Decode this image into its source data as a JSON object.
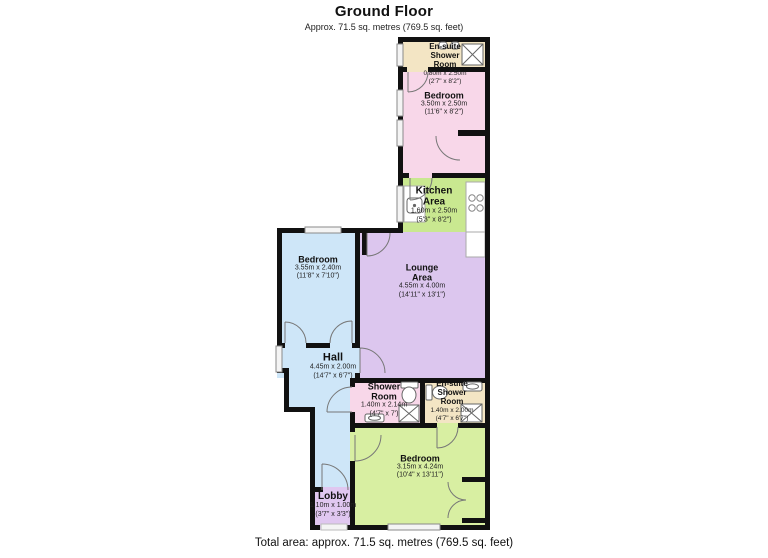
{
  "header": {
    "title": "Ground Floor",
    "subtitle": "Approx. 71.5 sq. metres (769.5 sq. feet)"
  },
  "footer": {
    "total_area": "Total area: approx. 71.5 sq. metres (769.5 sq. feet)"
  },
  "colors": {
    "wall": "#111111",
    "window_stroke": "#8a8a8a",
    "fixture_stroke": "#666666"
  },
  "rooms": [
    {
      "id": "ensuite-top",
      "name": "En-suite\nShower\nRoom",
      "dims_m": "0.80m x 2.50m",
      "dims_ft": "(2'7\" x 8'2\")",
      "color": "#F3E5C4"
    },
    {
      "id": "bedroom-top",
      "name": "Bedroom",
      "dims_m": "3.50m x 2.50m",
      "dims_ft": "(11'6\" x 8'2\")",
      "color": "#F8D7E9"
    },
    {
      "id": "kitchen",
      "name": "Kitchen\nArea",
      "dims_m": "1.60m x 2.50m",
      "dims_ft": "(5'3\" x 8'2\")",
      "color": "#C9E890"
    },
    {
      "id": "bedroom-left",
      "name": "Bedroom",
      "dims_m": "3.55m x 2.40m",
      "dims_ft": "(11'8\" x 7'10\")",
      "color": "#CEE6F8"
    },
    {
      "id": "lounge",
      "name": "Lounge\nArea",
      "dims_m": "4.55m x 4.00m",
      "dims_ft": "(14'11\" x 13'1\")",
      "color": "#DCC6EE"
    },
    {
      "id": "hall",
      "name": "Hall",
      "dims_m": "4.45m x 2.00m",
      "dims_ft": "(14'7\" x 6'7\")",
      "color": "#CEE6F8"
    },
    {
      "id": "shower-room",
      "name": "Shower\nRoom",
      "dims_m": "1.40m x 2.14m",
      "dims_ft": "(4'7\" x 7')",
      "color": "#F8D7E9"
    },
    {
      "id": "ensuite-bottom",
      "name": "En-suite\nShower\nRoom",
      "dims_m": "1.40m x 2.00m",
      "dims_ft": "(4'7\" x 6'7\")",
      "color": "#F3E5C4"
    },
    {
      "id": "bedroom-bottom",
      "name": "Bedroom",
      "dims_m": "3.15m x 4.24m",
      "dims_ft": "(10'4\" x 13'11\")",
      "color": "#D8EFA2"
    },
    {
      "id": "lobby",
      "name": "Lobby",
      "dims_m": "1.10m x 1.00m",
      "dims_ft": "(3'7\" x 3'3\")",
      "color": "#E0C7F0"
    }
  ]
}
